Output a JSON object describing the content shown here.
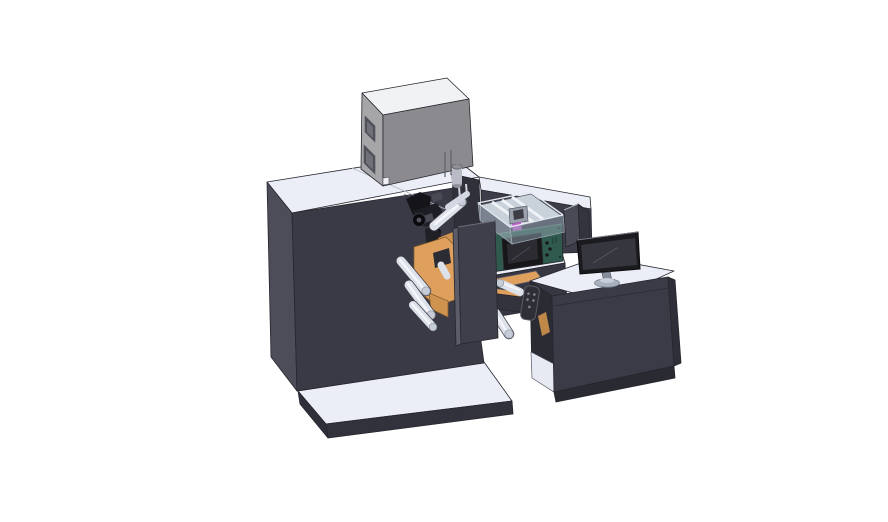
{
  "palette": {
    "bg": "#ffffff",
    "surface_top": "#ebedf7",
    "cabinet_front": "#3a3a46",
    "cabinet_side": "#4d4d5a",
    "dark_panel": "#30303a",
    "platform_front": "#32323c",
    "platform_side": "#2f2f39",
    "wing_front": "#3d3d4a",
    "wing_lower": "#373743",
    "box_top": "#f1f2f4",
    "box_side": "#a6a6a9",
    "box_front": "#8b8b8f",
    "box_window": "#4f4f56",
    "box_window_inner": "#70707a",
    "cylinder_body": "#b9bcc6",
    "cylinder_cap": "#8f8f97",
    "glass_floor": "#c9d1db",
    "glass_rib": "#eff2f6",
    "glass_wall_left": "rgba(173,188,201,0.55)",
    "glass_wall_right": "rgba(150,166,180,0.5)",
    "glass_edge": "#e7ebf1",
    "inner_mech": "#9aa1ac",
    "inner_mech_dark": "#3e3e46",
    "magenta": "#c55ed2",
    "green_panel": "#2f5a4d",
    "green_side": "#24453c",
    "green_edge_hl": "#55806f",
    "display_bezel": "#17171a",
    "display_screen": "#2b2b31",
    "mech_black": "#141419",
    "mech_black2": "#1d1d24",
    "mech_detail": "#4a4a54",
    "mech_arm": "#202027",
    "orange": "#dfa05e",
    "orange_dark": "#cf9350",
    "orange_deep": "#c08848",
    "notch_dark": "#2c2c34",
    "roller": "#dde1ea",
    "roller_hl": "#f4f6fa",
    "roller_cap": "#c6ccd8",
    "roller_edge": "#3a3a42",
    "plate": "#3f3f4c",
    "plate_side": "#5c5c68",
    "beam": "#33333d",
    "shield_left": "#4a4a57",
    "shield_right": "#34343e",
    "desk_front": "#3b3b48",
    "desk_base": "#2a2a33",
    "desk_interior": "#2b2b34",
    "desk_right": "#2f2f39",
    "shelf": "#e7eaf3",
    "monitor_bezel": "#1a1a1f",
    "monitor_screen": "#36363f",
    "monitor_hl": "#55555f",
    "stand": "#868e9b",
    "stand_base": "#a9b1be",
    "stand_base_top": "#c9cfda",
    "pendant": "#2e2e37",
    "pendant_dot": "#83838d",
    "slot_light": "#cfd2dc",
    "seam_light": "#b6b9c8",
    "seam_dash": "#6a6a74",
    "white_detail": "#f2f2f4"
  }
}
